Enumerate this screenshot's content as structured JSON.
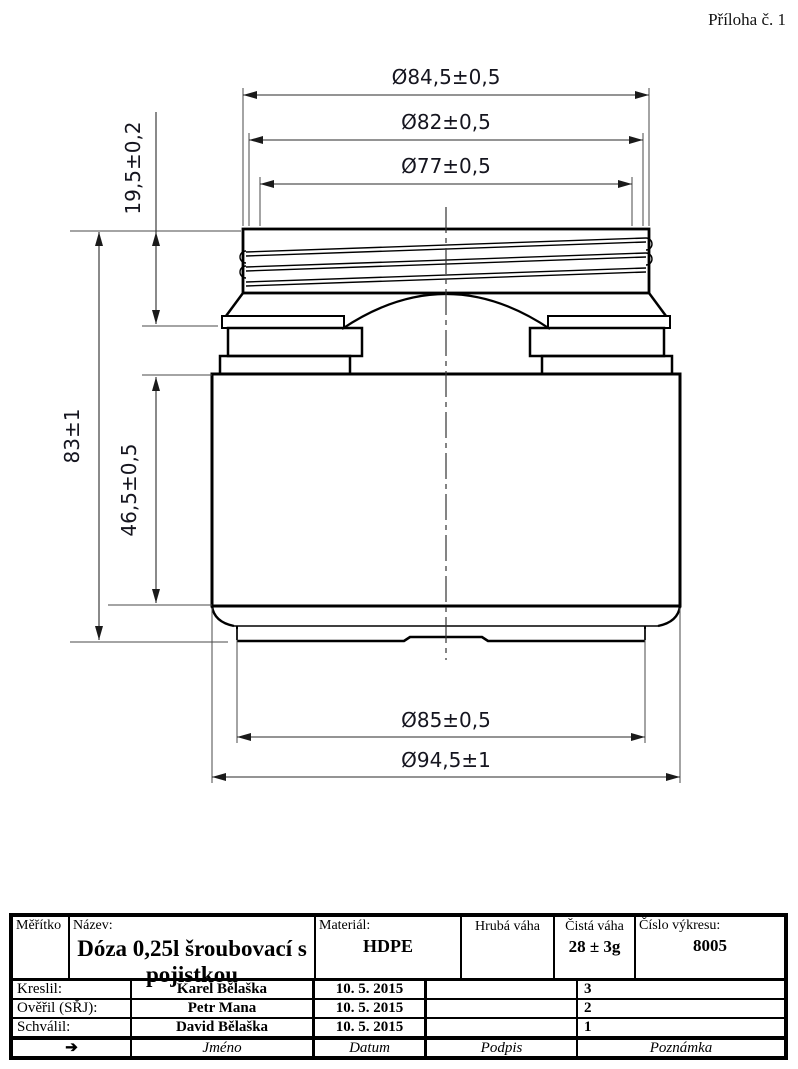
{
  "attachment": "Příloha č. 1",
  "colors": {
    "ink": "#000000",
    "dim_text": "#15151f"
  },
  "dimensions": {
    "top_diameters": [
      "Ø84,5±0,5",
      "Ø82±0,5",
      "Ø77±0,5"
    ],
    "neck_height": "19,5±0,2",
    "total_height": "83±1",
    "body_height": "46,5±0,5",
    "bottom_diameters": [
      "Ø85±0,5",
      "Ø94,5±1"
    ]
  },
  "title_block": {
    "scale_label": "Měřítko",
    "name_label": "Název:",
    "name_value": "Dóza 0,25l šroubovací s pojistkou",
    "material_label": "Materiál:",
    "material_value": "HDPE",
    "gross_weight_label": "Hrubá váha",
    "net_weight_label": "Čistá váha",
    "net_weight_value": "28 ± 3g",
    "drawing_number_label": "Číslo výkresu:",
    "drawing_number_value": "8005",
    "rows": [
      {
        "role": "Kreslil:",
        "name": "Karel Bělaška",
        "date": "10. 5. 2015",
        "signature": "",
        "note": "3"
      },
      {
        "role": "Ověřil (SŘJ):",
        "name": "Petr Mana",
        "date": "10. 5. 2015",
        "signature": "",
        "note": "2"
      },
      {
        "role": "Schválil:",
        "name": "David Bělaška",
        "date": "10. 5. 2015",
        "signature": "",
        "note": "1"
      }
    ],
    "footer": {
      "arrow": "➔",
      "name": "Jméno",
      "date": "Datum",
      "signature": "Podpis",
      "note": "Poznámka"
    }
  }
}
